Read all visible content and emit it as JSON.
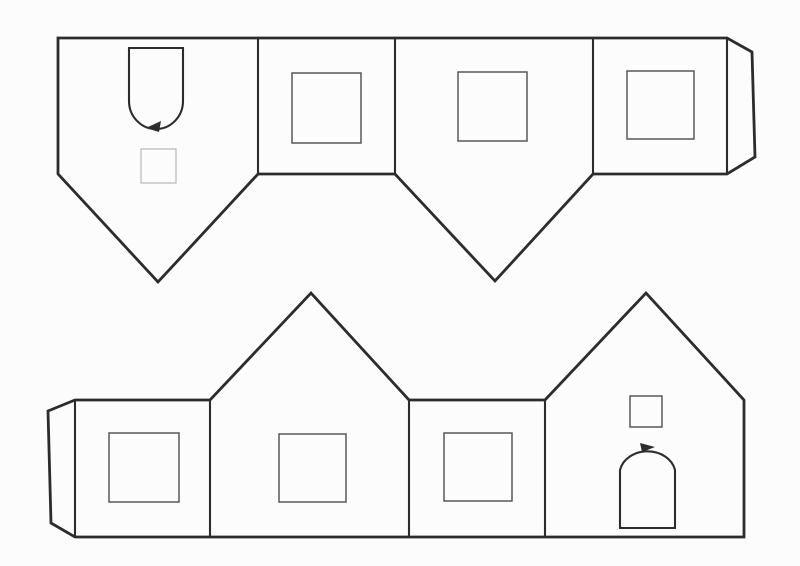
{
  "document": {
    "title": "Paper house craft template (scanned line drawing)",
    "description": "Two fold-up strips of house wall panels with square windows, arched doors and glue tabs"
  },
  "palette": {
    "paper": "#fcfcfc",
    "ink": "#2c2c2c",
    "ink_medium": "#585858",
    "ink_light": "#b6b6b6"
  },
  "stroke_widths": {
    "outline": 2.8,
    "fold": 2.1,
    "window": 1.5,
    "faint": 1.2
  },
  "shapes": [
    {
      "kind": "polygon",
      "name": "top-strip-outline",
      "points": [
        [
          58,
          38
        ],
        [
          727,
          38
        ],
        [
          752,
          52
        ],
        [
          755,
          157
        ],
        [
          727,
          174
        ],
        [
          593,
          174
        ],
        [
          495,
          281
        ],
        [
          395,
          174
        ],
        [
          258,
          174
        ],
        [
          158,
          282
        ],
        [
          58,
          174
        ]
      ],
      "stroke": "ink",
      "weight": "outline",
      "fill": "paper"
    },
    {
      "kind": "polygon",
      "name": "bottom-strip-outline",
      "points": [
        [
          48,
          411
        ],
        [
          75,
          400
        ],
        [
          210,
          400
        ],
        [
          311,
          293
        ],
        [
          409,
          400
        ],
        [
          545,
          400
        ],
        [
          646,
          293
        ],
        [
          744,
          400
        ],
        [
          744,
          537
        ],
        [
          75,
          537
        ],
        [
          51,
          523
        ]
      ],
      "stroke": "ink",
      "weight": "outline",
      "fill": "paper"
    },
    {
      "kind": "line",
      "name": "fold-line-top-1",
      "x1": 258,
      "y1": 39,
      "x2": 258,
      "y2": 173,
      "stroke": "ink",
      "weight": "fold"
    },
    {
      "kind": "line",
      "name": "fold-line-top-2",
      "x1": 395,
      "y1": 39,
      "x2": 395,
      "y2": 173,
      "stroke": "ink",
      "weight": "fold"
    },
    {
      "kind": "line",
      "name": "fold-line-top-3",
      "x1": 593,
      "y1": 39,
      "x2": 593,
      "y2": 173,
      "stroke": "ink",
      "weight": "fold"
    },
    {
      "kind": "line",
      "name": "fold-line-top-tab",
      "x1": 727,
      "y1": 40,
      "x2": 727,
      "y2": 173,
      "stroke": "ink",
      "weight": "fold"
    },
    {
      "kind": "line",
      "name": "fold-line-bottom-tab",
      "x1": 75,
      "y1": 401,
      "x2": 75,
      "y2": 536,
      "stroke": "ink",
      "weight": "fold"
    },
    {
      "kind": "line",
      "name": "fold-line-bottom-1",
      "x1": 210,
      "y1": 401,
      "x2": 210,
      "y2": 536,
      "stroke": "ink",
      "weight": "fold"
    },
    {
      "kind": "line",
      "name": "fold-line-bottom-2",
      "x1": 409,
      "y1": 401,
      "x2": 409,
      "y2": 536,
      "stroke": "ink",
      "weight": "fold"
    },
    {
      "kind": "line",
      "name": "fold-line-bottom-3",
      "x1": 545,
      "y1": 401,
      "x2": 545,
      "y2": 536,
      "stroke": "ink",
      "weight": "fold"
    },
    {
      "kind": "path",
      "name": "door-arched-inverted",
      "d": "M 129,48 L 183,48 L 183,101 A 27 28 0 0 1 129,101 Z",
      "stroke": "ink",
      "weight": "fold",
      "fill": "none"
    },
    {
      "kind": "polygon",
      "name": "arrow-marker-top-door",
      "points": [
        [
          161,
          121
        ],
        [
          146,
          128
        ],
        [
          159,
          132
        ]
      ],
      "stroke": "none",
      "fillColor": "ink"
    },
    {
      "kind": "rect",
      "name": "window-small-faint",
      "x": 141,
      "y": 149,
      "w": 35,
      "h": 34,
      "stroke": "ink_light",
      "weight": "faint"
    },
    {
      "kind": "rect",
      "name": "window-top-panel2",
      "x": 292,
      "y": 73,
      "w": 69,
      "h": 70,
      "stroke": "ink_medium",
      "weight": "window"
    },
    {
      "kind": "rect",
      "name": "window-top-panel3",
      "x": 458,
      "y": 72,
      "w": 69,
      "h": 69,
      "stroke": "ink_medium",
      "weight": "window"
    },
    {
      "kind": "rect",
      "name": "window-top-panel4",
      "x": 627,
      "y": 71,
      "w": 67,
      "h": 68,
      "stroke": "ink_medium",
      "weight": "window"
    },
    {
      "kind": "rect",
      "name": "window-bottom-panel1",
      "x": 109,
      "y": 433,
      "w": 70,
      "h": 69,
      "stroke": "ink_medium",
      "weight": "window"
    },
    {
      "kind": "rect",
      "name": "window-bottom-panel2",
      "x": 279,
      "y": 434,
      "w": 67,
      "h": 68,
      "stroke": "ink_medium",
      "weight": "window"
    },
    {
      "kind": "rect",
      "name": "window-bottom-panel3",
      "x": 444,
      "y": 433,
      "w": 68,
      "h": 68,
      "stroke": "ink_medium",
      "weight": "window"
    },
    {
      "kind": "rect",
      "name": "window-attic-small",
      "x": 630,
      "y": 396,
      "w": 32,
      "h": 31,
      "stroke": "ink_medium",
      "weight": "window"
    },
    {
      "kind": "path",
      "name": "door-arched-upright",
      "d": "M 620,528 L 620,470 A 28 23 0 0 1 675,470 L 675,528 Z",
      "stroke": "ink",
      "weight": "fold",
      "fill": "none"
    },
    {
      "kind": "polygon",
      "name": "arrow-marker-bottom-door",
      "points": [
        [
          640,
          443
        ],
        [
          655,
          447
        ],
        [
          642,
          452
        ]
      ],
      "stroke": "none",
      "fillColor": "ink"
    }
  ]
}
